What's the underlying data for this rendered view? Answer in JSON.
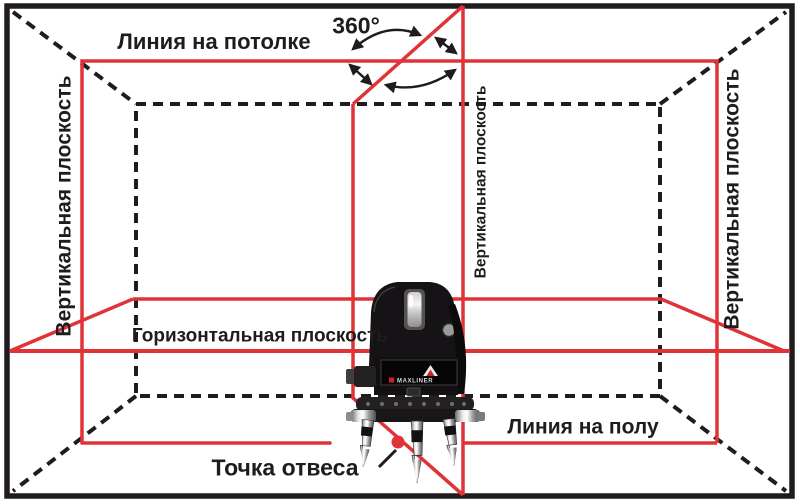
{
  "labels": {
    "ceiling_line": "Линия на потолке",
    "rotation_angle": "360°",
    "left_wall_plane": "Вертикальная плоскость",
    "middle_plane": "Вертикальная плоскость",
    "right_wall_plane": "Вертикальная плоскость",
    "horizontal_plane": "Горизонтальная плоскость",
    "floor_line": "Линия на полу",
    "plumb_point": "Точка отвеса"
  },
  "device": {
    "label_text": "MAXLINER"
  },
  "colors": {
    "laser_line": "#e03338",
    "room_line": "#201c1d",
    "background": "#ffffff"
  }
}
